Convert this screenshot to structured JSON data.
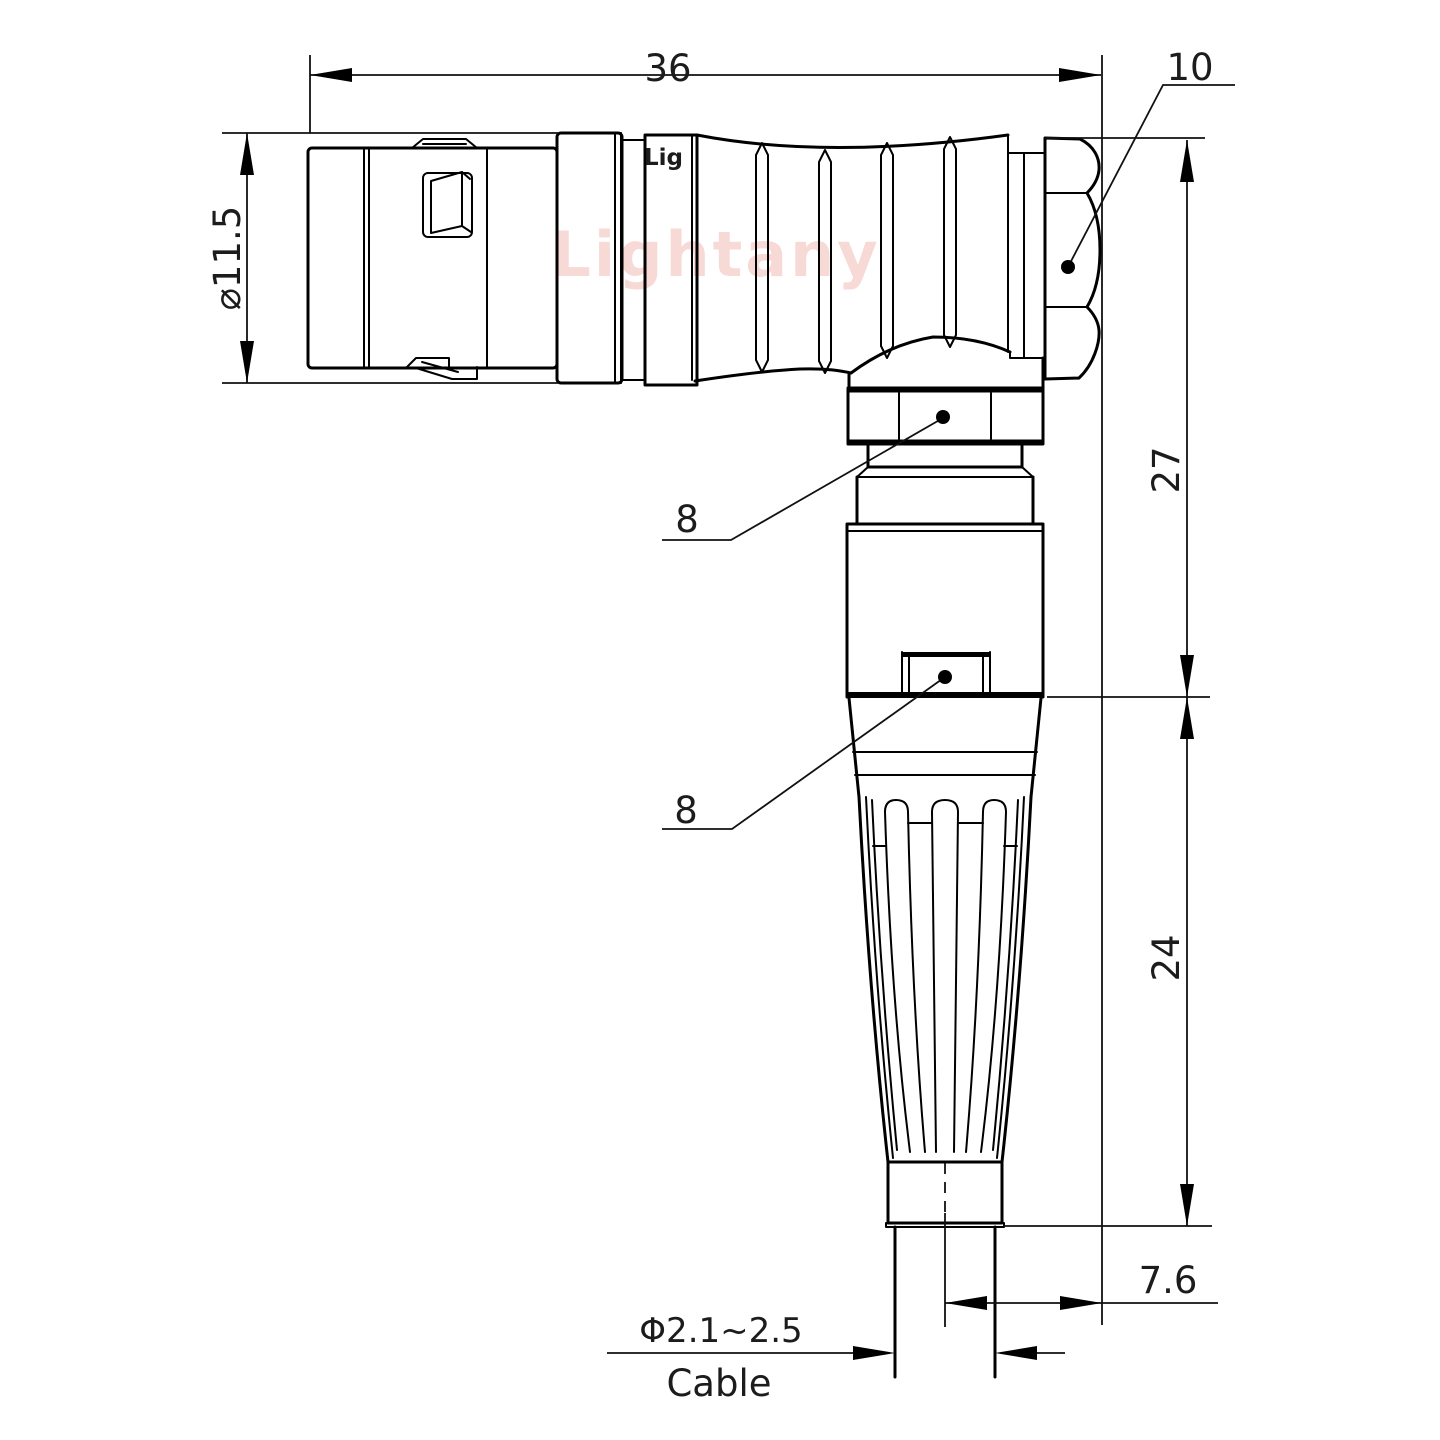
{
  "drawing": {
    "type": "technical-drawing",
    "description": "Right-angle circular push-pull connector, side elevation with dimensions",
    "line_color": "#000000",
    "background_color": "#ffffff",
    "watermark": "Lightany",
    "watermark_color": "#f0b5ad",
    "engraving": "Lig",
    "labels": {
      "overall_length": "36",
      "back_nut_width": "10",
      "front_diameter": "⌀11.5",
      "upper_height": "27",
      "lower_height": "24",
      "upper_hex": "8",
      "lower_hex": "8",
      "cable_center_offset": "7.6",
      "cable_diameter_range": "Φ2.1~2.5",
      "cable_word": "Cable"
    }
  }
}
